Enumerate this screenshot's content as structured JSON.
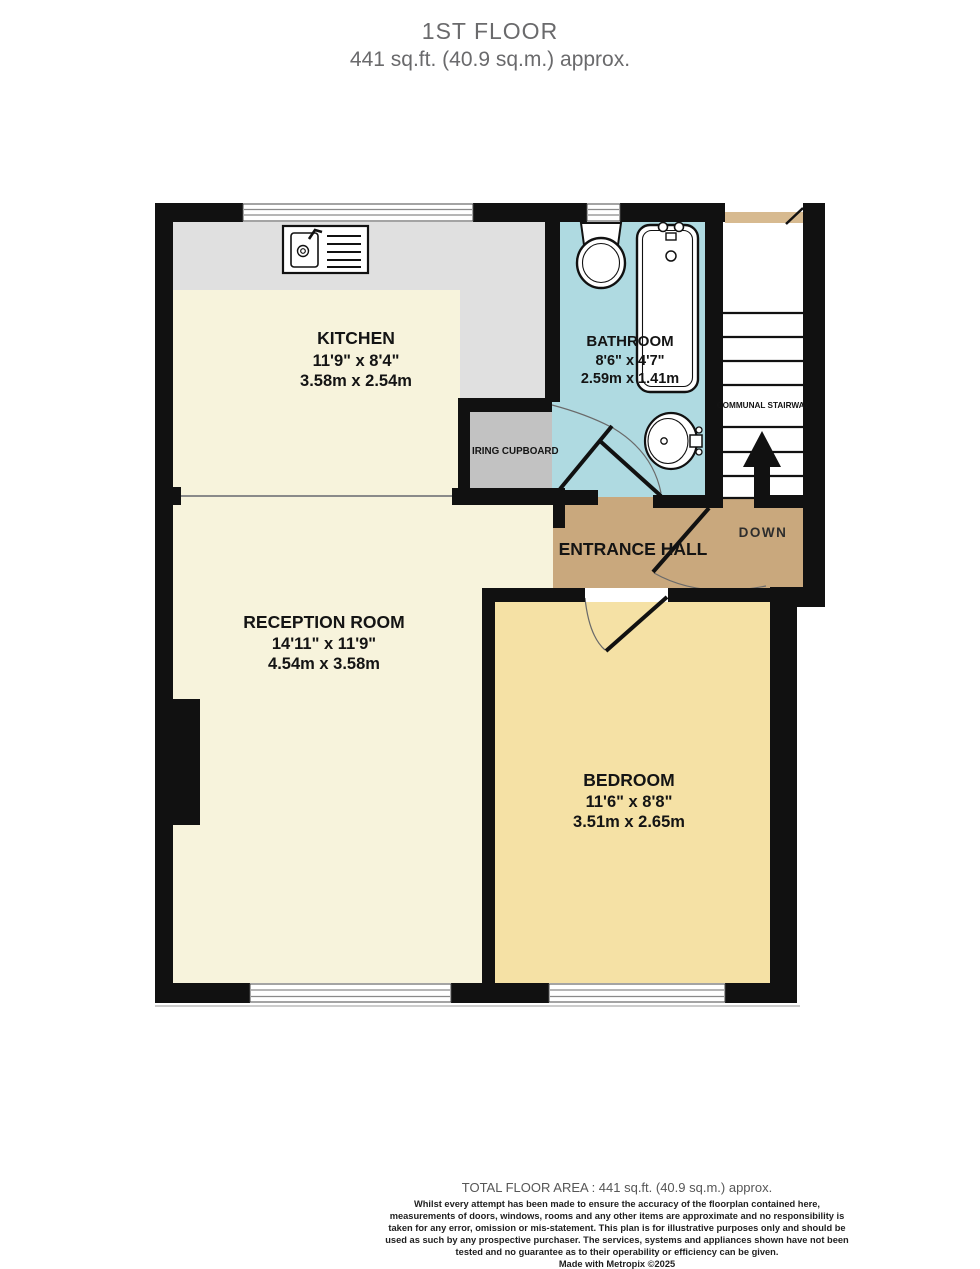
{
  "title": {
    "line1": "1ST FLOOR",
    "line2": "441 sq.ft. (40.9 sq.m.) approx."
  },
  "rooms": {
    "kitchen": {
      "name": "KITCHEN",
      "imperial": "11'9\" x 8'4\"",
      "metric": "3.58m x 2.54m"
    },
    "bathroom": {
      "name": "BATHROOM",
      "imperial": "8'6\" x 4'7\"",
      "metric": "2.59m x 1.41m"
    },
    "reception": {
      "name": "RECEPTION ROOM",
      "imperial": "14'11\" x 11'9\"",
      "metric": "4.54m x 3.58m"
    },
    "bedroom": {
      "name": "BEDROOM",
      "imperial": "11'6\" x 8'8\"",
      "metric": "3.51m x 2.65m"
    },
    "entrance_hall": {
      "name": "ENTRANCE HALL"
    },
    "airing_cupboard": {
      "name": "IRING CUPBOARD"
    },
    "stairway": {
      "name": "COMMUNAL STAIRWAY",
      "direction": "DOWN"
    }
  },
  "footer": {
    "total_area": "TOTAL FLOOR AREA : 441 sq.ft. (40.9 sq.m.) approx.",
    "disclaimer": "Whilst every attempt has been made to ensure the accuracy of the floorplan contained here, measurements of doors, windows, rooms and any other items are approximate and no responsibility is taken for any error, omission or mis-statement. This plan is for illustrative purposes only and should be used as such by any prospective purchaser. The services, systems and appliances shown have not been tested and no guarantee as to their operability or efficiency can be given.",
    "credit": "Made with Metropix ©2025"
  },
  "colors": {
    "wall": "#111111",
    "kitchen_reception": "#f7f3dc",
    "bedroom": "#f5e1a5",
    "entrance_hall": "#c9a87d",
    "bathroom": "#afdae1",
    "counter": "#e0e0e0",
    "cupboard": "#c2c2c2",
    "landing": "#d7ba90",
    "title_text": "#6a6a6c"
  }
}
